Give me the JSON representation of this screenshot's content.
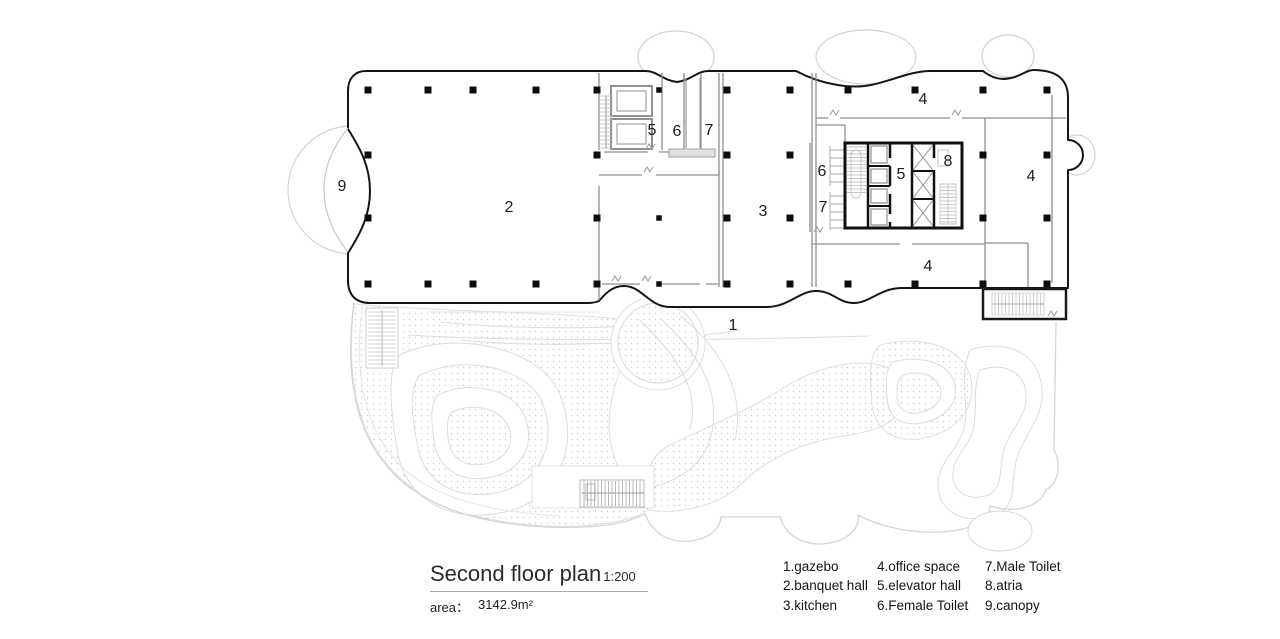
{
  "title": {
    "text": "Second floor plan",
    "scale": "1:200",
    "area_label": "area：",
    "area_value": "3142.9m²"
  },
  "legend": [
    [
      {
        "num": "1",
        "label": "gazebo"
      },
      {
        "num": "2",
        "label": "banquet hall"
      },
      {
        "num": "3",
        "label": "kitchen"
      }
    ],
    [
      {
        "num": "4",
        "label": "office space"
      },
      {
        "num": "5",
        "label": "elevator hall"
      },
      {
        "num": "6",
        "label": "Female Toilet"
      }
    ],
    [
      {
        "num": "7",
        "label": "Male Toilet"
      },
      {
        "num": "8",
        "label": "atria"
      },
      {
        "num": "9",
        "label": "canopy"
      }
    ]
  ],
  "plan_labels": [
    {
      "text": "9",
      "x": 342,
      "y": 187
    },
    {
      "text": "2",
      "x": 509,
      "y": 208
    },
    {
      "text": "5",
      "x": 652,
      "y": 131
    },
    {
      "text": "6",
      "x": 677,
      "y": 132
    },
    {
      "text": "7",
      "x": 709,
      "y": 131
    },
    {
      "text": "3",
      "x": 763,
      "y": 212
    },
    {
      "text": "4",
      "x": 923,
      "y": 100
    },
    {
      "text": "6",
      "x": 822,
      "y": 172
    },
    {
      "text": "7",
      "x": 823,
      "y": 208
    },
    {
      "text": "5",
      "x": 901,
      "y": 175
    },
    {
      "text": "8",
      "x": 948,
      "y": 162
    },
    {
      "text": "4",
      "x": 1031,
      "y": 177
    },
    {
      "text": "4",
      "x": 928,
      "y": 267
    },
    {
      "text": "1",
      "x": 733,
      "y": 326
    }
  ],
  "colors": {
    "outer_wall": "#161616",
    "inner_wall": "#8f8f8f",
    "fixture": "#c6c6c6",
    "landscape": "#d9d9d9",
    "text": "#1c1c1c"
  }
}
